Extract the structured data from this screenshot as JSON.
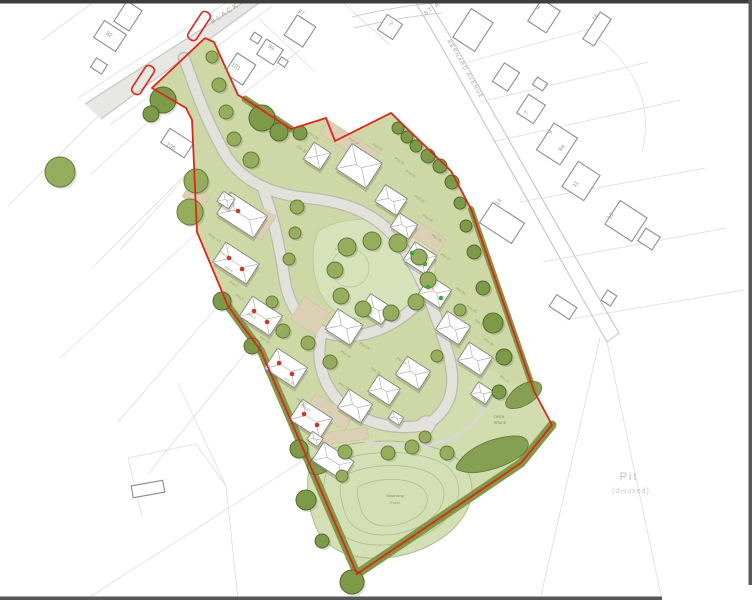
{
  "canvas": {
    "width": 752,
    "height": 600,
    "background": "#ffffff"
  },
  "colors": {
    "site_fill": "#cdd8a6",
    "open_space_fill": "#d1dcaf",
    "lap_fill": "#d8e2ba",
    "lap_stroke": "#bac697",
    "pond_fill": "#d5dfb5",
    "pond_contour": "#b0bc90",
    "road_fill": "#e2e2db",
    "road_casing": "#b9bab1",
    "existing_road_fill": "#e7e7e4",
    "existing_road_edge": "#c6c6c2",
    "footpath": "#d8d8d1",
    "tan_fill": "#dbcfb4",
    "tan_stroke": "#cabfa2",
    "parcel_line": "#dcdcd9",
    "building_stroke": "#8f8f8c",
    "house_stroke": "#85857f",
    "roof_line": "#b3b3ad",
    "tree_fill": "#95ad5d",
    "tree_stroke": "#647c35",
    "tree_dark_fill": "#7d9a48",
    "tree_dark_stroke": "#526b2b",
    "hedge": "#7e9a46",
    "boundary_red": "#e1251b",
    "marker_red": "#d93025",
    "marker_green": "#3daa35",
    "label_gray": "#9b9b98",
    "street_gray": "#a3a3a0",
    "plot_label": "#8e9c6a",
    "pit_gray": "#c2c2c0"
  },
  "viewer_edges": [
    {
      "x": 0,
      "y": 0,
      "w": 752,
      "h": 3.5,
      "c": "#3d3d3d"
    },
    {
      "x": 748.5,
      "y": 0,
      "w": 3.5,
      "h": 585,
      "c": "#5a5a5a"
    },
    {
      "x": 0,
      "y": 596.5,
      "w": 662,
      "h": 3.5,
      "c": "#575757"
    }
  ],
  "parcel_lines": [
    [
      98,
      116,
      8,
      206
    ],
    [
      190,
      170,
      92,
      268
    ],
    [
      197,
      233,
      60,
      358
    ],
    [
      222,
      301,
      118,
      422
    ],
    [
      251,
      346,
      148,
      474
    ],
    [
      178,
      383,
      226,
      486
    ],
    [
      226,
      486,
      238,
      600
    ],
    [
      88,
      598,
      310,
      456
    ],
    [
      128,
      458,
      196,
      444
    ],
    [
      196,
      444,
      226,
      486
    ],
    [
      128,
      458,
      142,
      516
    ],
    [
      468,
      62,
      608,
      24
    ],
    [
      480,
      102,
      648,
      62
    ],
    [
      492,
      142,
      680,
      100
    ],
    [
      520,
      202,
      706,
      168
    ],
    [
      543,
      262,
      726,
      228
    ],
    [
      566,
      320,
      744,
      290
    ],
    [
      607,
      342,
      662,
      600
    ],
    [
      600,
      338,
      540,
      600
    ],
    [
      258,
      18,
      315,
      72
    ],
    [
      300,
      50,
      240,
      96
    ],
    [
      340,
      0,
      390,
      45
    ],
    [
      150,
      120,
      90,
      175
    ],
    [
      200,
      160,
      120,
      250
    ],
    [
      96,
      0,
      42,
      40
    ]
  ],
  "existing_roads": [
    {
      "d": "M247,0 L263,0 L101,119 L85,104 Z",
      "fill": "#e7e7e4"
    },
    {
      "d": "M247,0 L85,104",
      "stroke": "#c6c6c2",
      "w": 1.2
    },
    {
      "d": "M263,0 L101,119",
      "stroke": "#c6c6c2",
      "w": 1.2
    },
    {
      "d": "M272,6 L110,125",
      "stroke": "#dddddb",
      "w": 0.8
    },
    {
      "d": "M78,98 L240,-6",
      "stroke": "#dddddb",
      "w": 0.8
    },
    {
      "d": "M414,0 C446,52 510,170 607,342",
      "stroke": "#c6c6c2",
      "w": 1.1
    },
    {
      "d": "M428,0 C460,50 522,166 619,333",
      "stroke": "#c6c6c2",
      "w": 1.1
    },
    {
      "d": "M607,342 L619,333",
      "stroke": "#c6c6c2",
      "w": 1
    },
    {
      "d": "M352,17 Q392,7 434,3",
      "stroke": "#cfcfcb",
      "w": 1
    },
    {
      "d": "M354,28 Q396,18 441,13",
      "stroke": "#cfcfcb",
      "w": 1
    },
    {
      "d": "M600,40 Q658,86 642,152",
      "stroke": "#e0e0dd",
      "w": 0.8
    }
  ],
  "existing_buildings": [
    [
      110,
      36,
      26,
      20,
      33
    ],
    [
      128,
      16,
      18,
      24,
      33
    ],
    [
      99,
      66,
      13,
      11,
      33
    ],
    [
      177,
      143,
      28,
      17,
      33
    ],
    [
      240,
      69,
      22,
      24,
      33
    ],
    [
      270,
      52,
      20,
      18,
      33
    ],
    [
      300,
      31,
      22,
      24,
      33
    ],
    [
      390,
      27,
      18,
      18,
      33
    ],
    [
      473,
      30,
      26,
      34,
      33
    ],
    [
      506,
      77,
      18,
      22,
      33
    ],
    [
      531,
      109,
      20,
      22,
      33
    ],
    [
      557,
      144,
      28,
      32,
      33
    ],
    [
      581,
      181,
      26,
      30,
      33
    ],
    [
      626,
      221,
      32,
      28,
      33
    ],
    [
      502,
      223,
      38,
      24,
      33
    ],
    [
      544,
      16,
      22,
      26,
      33
    ],
    [
      597,
      29,
      13,
      32,
      33
    ],
    [
      563,
      307,
      24,
      14,
      33
    ],
    [
      609,
      298,
      11,
      12,
      33
    ],
    [
      649,
      239,
      17,
      15,
      33
    ],
    [
      148,
      489,
      32,
      12,
      -10
    ],
    [
      256,
      38,
      9,
      8,
      33
    ],
    [
      283,
      62,
      8,
      7,
      33
    ],
    [
      540,
      84,
      12,
      9,
      33
    ]
  ],
  "site": {
    "fill_d": "M205,38 L214,42 L238,95 L245,99 L291,129 L326,118 L335,141 L391,113 L451,171 L471,209 L534,391 L552,425 L521,463 L357,574 L304,451 L261,351 L228,306 L197,232 L192,120 L186,108 L152,88 Z",
    "boundary_d": "M205,38 L214,42 L238,95 L245,99 L291,129 L326,118 L335,141 L391,113 L451,171 L471,209 L534,391 L552,425 L521,463 L357,574 L304,451 L261,351 L228,306 L197,232 L192,120 L186,108 L152,88 L205,38",
    "open_space_d": "M447,350 L534,391 L552,425 L521,463 L357,574 L304,451 L340,402 C362,424 398,432 428,424 C446,414 452,384 447,350 Z",
    "splays": [
      {
        "x": 199,
        "y": 26,
        "w": 10,
        "h": 32,
        "r": 33
      },
      {
        "x": 143,
        "y": 80,
        "w": 10,
        "h": 32,
        "r": 33
      }
    ]
  },
  "lap": {
    "blob_d": "M318,232 C330,222 352,218 375,220 C400,222 420,228 430,244 C438,258 436,278 428,294 C418,312 398,320 374,320 C348,320 330,312 322,296 C312,278 310,248 318,232 Z",
    "play_circle": {
      "cx": 350,
      "cy": 268,
      "r": 19
    }
  },
  "pond": {
    "basin_d": "M316,455 C350,438 410,436 446,452 C472,464 478,490 466,512 C452,538 418,556 382,558 C348,560 322,548 314,522 C306,500 304,470 316,455 Z",
    "contours": [
      "M330,465 C358,450 408,448 438,461 C458,470 464,490 454,508 C442,530 414,544 384,545 C356,546 334,536 328,515 C322,498 322,477 330,465 Z",
      "M344,476 C366,464 404,462 428,472 C444,480 448,494 440,508 C430,524 408,534 386,535 C364,536 348,527 344,510 C340,496 338,486 344,476 Z",
      "M358,487 C374,478 400,477 416,484 C428,490 430,500 424,510 C416,520 400,526 386,526 C372,526 362,518 360,506 C358,498 356,493 358,487 Z"
    ]
  },
  "internal_roads": [
    "M184,58 C196,90 204,116 224,152 C240,180 268,194 308,198 C346,202 372,212 394,236 C418,264 434,308 447,350 C458,384 452,408 428,424",
    "M262,186 C274,218 280,248 284,276 C288,304 299,321 322,331 C352,344 396,332 428,292",
    "M322,331 C316,356 320,382 340,402 C362,424 398,432 428,424"
  ],
  "turning_head": {
    "cx": 426,
    "cy": 425,
    "r": 8.5
  },
  "footpath_d": "M366,441 C396,450 428,448 452,438 C468,430 478,420 486,406",
  "tan_areas": [
    [
      349,
      143,
      60,
      16,
      33
    ],
    [
      310,
      316,
      30,
      26,
      33
    ],
    [
      330,
      412,
      44,
      18,
      30
    ],
    [
      428,
      237,
      34,
      16,
      33
    ],
    [
      196,
      197,
      24,
      14,
      33
    ],
    [
      345,
      436,
      46,
      12,
      -8
    ],
    [
      262,
      224,
      16,
      28,
      33
    ]
  ],
  "hedges": [
    {
      "d": "M228,306 L261,351 L304,451 L357,574",
      "w": 8
    },
    {
      "d": "M552,425 L521,463 L357,574",
      "w": 9
    },
    {
      "d": "M471,209 L534,391",
      "w": 6
    },
    {
      "d": "M245,99 L291,129",
      "w": 7
    }
  ],
  "mounds": [
    "M458,463 C468,448 490,438 512,436 C527,435 533,443 524,453 C509,467 478,475 465,472 C456,470 454,469 458,463 Z",
    "M509,396 C515,386 528,380 537,382 C544,384 543,392 535,399 C526,407 515,410 509,408 C504,406 505,401 509,396 Z",
    "M310,462 C316,452 328,448 334,452 C339,456 336,464 328,470 C320,476 310,476 308,470 C307,467 307,465 310,462 Z"
  ],
  "houses": [
    {
      "x": 242,
      "y": 215,
      "w": 44,
      "h": 26,
      "r": 33
    },
    {
      "x": 226,
      "y": 200,
      "w": 14,
      "h": 12,
      "r": 33
    },
    {
      "x": 236,
      "y": 263,
      "w": 40,
      "h": 24,
      "r": 33
    },
    {
      "x": 261,
      "y": 316,
      "w": 36,
      "h": 24,
      "r": 33
    },
    {
      "x": 286,
      "y": 368,
      "w": 36,
      "h": 24,
      "r": 33
    },
    {
      "x": 311,
      "y": 419,
      "w": 36,
      "h": 24,
      "r": 33
    },
    {
      "x": 333,
      "y": 461,
      "w": 36,
      "h": 22,
      "r": 33
    },
    {
      "x": 315,
      "y": 439,
      "w": 13,
      "h": 10,
      "r": 33
    },
    {
      "x": 355,
      "y": 406,
      "w": 28,
      "h": 22,
      "r": 33
    },
    {
      "x": 384,
      "y": 390,
      "w": 26,
      "h": 20,
      "r": 33
    },
    {
      "x": 413,
      "y": 373,
      "w": 28,
      "h": 22,
      "r": 33
    },
    {
      "x": 396,
      "y": 418,
      "w": 13,
      "h": 9,
      "r": 33
    },
    {
      "x": 344,
      "y": 327,
      "w": 30,
      "h": 24,
      "r": 33
    },
    {
      "x": 376,
      "y": 309,
      "w": 26,
      "h": 20,
      "r": 33
    },
    {
      "x": 317,
      "y": 156,
      "w": 20,
      "h": 20,
      "r": 33
    },
    {
      "x": 359,
      "y": 166,
      "w": 36,
      "h": 30,
      "r": 33
    },
    {
      "x": 391,
      "y": 200,
      "w": 26,
      "h": 20,
      "r": 33
    },
    {
      "x": 404,
      "y": 226,
      "w": 22,
      "h": 17,
      "r": 33
    },
    {
      "x": 420,
      "y": 258,
      "w": 26,
      "h": 22,
      "r": 33
    },
    {
      "x": 435,
      "y": 292,
      "w": 26,
      "h": 22,
      "r": 33
    },
    {
      "x": 453,
      "y": 328,
      "w": 28,
      "h": 22,
      "r": 33
    },
    {
      "x": 475,
      "y": 359,
      "w": 28,
      "h": 22,
      "r": 33
    },
    {
      "x": 482,
      "y": 393,
      "w": 18,
      "h": 15,
      "r": 33
    }
  ],
  "unit_markers": {
    "red": [
      [
        238,
        211
      ],
      [
        229,
        258
      ],
      [
        242,
        269
      ],
      [
        254,
        311
      ],
      [
        267,
        322
      ],
      [
        279,
        363
      ],
      [
        292,
        374
      ],
      [
        304,
        414
      ],
      [
        317,
        425
      ]
    ],
    "green": [
      [
        412,
        253
      ],
      [
        425,
        264
      ],
      [
        428,
        287
      ],
      [
        441,
        298
      ]
    ]
  },
  "trees": [
    [
      163,
      100,
      13,
      "d"
    ],
    [
      151,
      114,
      8,
      "d"
    ],
    [
      60,
      172,
      15,
      "n"
    ],
    [
      196,
      181,
      12,
      "n"
    ],
    [
      190,
      212,
      13,
      "n"
    ],
    [
      212,
      57,
      6,
      "n"
    ],
    [
      219,
      85,
      7,
      "n"
    ],
    [
      226,
      112,
      7,
      "n"
    ],
    [
      234,
      139,
      7,
      "n"
    ],
    [
      251,
      160,
      8,
      "n"
    ],
    [
      262,
      118,
      13,
      "d"
    ],
    [
      279,
      132,
      9,
      "d"
    ],
    [
      300,
      133,
      7,
      "d"
    ],
    [
      398,
      128,
      6,
      "d"
    ],
    [
      407,
      137,
      6,
      "d"
    ],
    [
      416,
      146,
      6,
      "d"
    ],
    [
      428,
      156,
      7,
      "d"
    ],
    [
      440,
      166,
      7,
      "d"
    ],
    [
      452,
      182,
      7,
      "d"
    ],
    [
      460,
      203,
      6,
      "d"
    ],
    [
      466,
      226,
      6,
      "d"
    ],
    [
      474,
      252,
      7,
      "d"
    ],
    [
      483,
      288,
      7,
      "d"
    ],
    [
      493,
      323,
      10,
      "d"
    ],
    [
      504,
      357,
      8,
      "d"
    ],
    [
      499,
      392,
      7,
      "d"
    ],
    [
      347,
      247,
      9,
      "n"
    ],
    [
      372,
      241,
      9,
      "n"
    ],
    [
      398,
      243,
      9,
      "n"
    ],
    [
      419,
      257,
      8,
      "n"
    ],
    [
      428,
      280,
      8,
      "n"
    ],
    [
      416,
      302,
      8,
      "n"
    ],
    [
      391,
      313,
      8,
      "n"
    ],
    [
      363,
      309,
      8,
      "n"
    ],
    [
      341,
      296,
      8,
      "n"
    ],
    [
      335,
      270,
      8,
      "n"
    ],
    [
      297,
      207,
      7,
      "n"
    ],
    [
      295,
      233,
      6,
      "n"
    ],
    [
      289,
      259,
      6,
      "n"
    ],
    [
      272,
      302,
      6,
      "n"
    ],
    [
      283,
      331,
      7,
      "n"
    ],
    [
      308,
      343,
      7,
      "n"
    ],
    [
      330,
      362,
      7,
      "n"
    ],
    [
      222,
      301,
      9,
      "d"
    ],
    [
      252,
      346,
      8,
      "d"
    ],
    [
      299,
      449,
      9,
      "d"
    ],
    [
      306,
      500,
      10,
      "d"
    ],
    [
      352,
      582,
      12,
      "d"
    ],
    [
      322,
      541,
      7,
      "d"
    ],
    [
      345,
      452,
      7,
      "n"
    ],
    [
      388,
      453,
      7,
      "n"
    ],
    [
      412,
      447,
      7,
      "n"
    ],
    [
      425,
      437,
      6,
      "n"
    ],
    [
      447,
      453,
      7,
      "n"
    ],
    [
      342,
      476,
      6,
      "n"
    ],
    [
      460,
      310,
      6,
      "n"
    ],
    [
      437,
      356,
      6,
      "n"
    ]
  ],
  "street_labels": [
    {
      "t": "BLACK",
      "x": 226,
      "y": 15,
      "rot": -33,
      "s": 7,
      "ls": 2
    },
    {
      "t": "ST A",
      "x": 433,
      "y": 10,
      "rot": -36,
      "s": 6,
      "ls": 1.5
    },
    {
      "t": "BERNARD AVENUE",
      "x": 464,
      "y": 70,
      "rot": 60,
      "s": 5.5,
      "ls": 1.2
    }
  ],
  "house_numbers": [
    {
      "t": "92",
      "x": 108,
      "y": 36,
      "rot": 33
    },
    {
      "t": "97",
      "x": 300,
      "y": 14,
      "rot": 33
    },
    {
      "t": "99",
      "x": 270,
      "y": 49,
      "rot": 33
    },
    {
      "t": "101",
      "x": 235,
      "y": 68,
      "rot": 33
    },
    {
      "t": "105",
      "x": 170,
      "y": 148,
      "rot": 33
    },
    {
      "t": "2",
      "x": 390,
      "y": 25,
      "rot": 33
    },
    {
      "t": "3",
      "x": 537,
      "y": 9,
      "rot": 33
    },
    {
      "t": "16",
      "x": 597,
      "y": 18,
      "rot": -57
    },
    {
      "t": "7",
      "x": 528,
      "y": 114,
      "rot": -57
    },
    {
      "t": "9",
      "x": 552,
      "y": 133,
      "rot": -57
    },
    {
      "t": "9a",
      "x": 563,
      "y": 149,
      "rot": -57
    },
    {
      "t": "11",
      "x": 577,
      "y": 185,
      "rot": -57
    },
    {
      "t": "13",
      "x": 612,
      "y": 217,
      "rot": -57
    },
    {
      "t": "14",
      "x": 500,
      "y": 203,
      "rot": -57
    }
  ],
  "plot_labels": [
    {
      "t": "Plots 1-4",
      "x": 214,
      "y": 239
    },
    {
      "t": "Plot 5",
      "x": 223,
      "y": 255
    },
    {
      "t": "Plot 6",
      "x": 228,
      "y": 270
    },
    {
      "t": "Plot 7",
      "x": 233,
      "y": 285
    },
    {
      "t": "Plot 8",
      "x": 239,
      "y": 298
    },
    {
      "t": "Plot 9",
      "x": 251,
      "y": 317
    },
    {
      "t": "Plot 10",
      "x": 264,
      "y": 341
    },
    {
      "t": "Plot 11",
      "x": 288,
      "y": 382
    },
    {
      "t": "Plot 12",
      "x": 301,
      "y": 403
    },
    {
      "t": "Plot 13",
      "x": 326,
      "y": 367
    },
    {
      "t": "Plot 14",
      "x": 345,
      "y": 355
    },
    {
      "t": "Plot 15",
      "x": 364,
      "y": 347
    },
    {
      "t": "Plot 16",
      "x": 343,
      "y": 387
    },
    {
      "t": "Plot 17",
      "x": 305,
      "y": 409
    },
    {
      "t": "Plot 18",
      "x": 375,
      "y": 372
    },
    {
      "t": "Plot 19",
      "x": 401,
      "y": 362
    },
    {
      "t": "Plot 20",
      "x": 499,
      "y": 397
    },
    {
      "t": "Plot 21",
      "x": 504,
      "y": 380
    },
    {
      "t": "Plot 22",
      "x": 496,
      "y": 362
    },
    {
      "t": "Plot 23",
      "x": 488,
      "y": 343
    },
    {
      "t": "Plot 24",
      "x": 479,
      "y": 324
    },
    {
      "t": "Plot 25",
      "x": 471,
      "y": 310
    },
    {
      "t": "Plot 26",
      "x": 460,
      "y": 292
    },
    {
      "t": "Plot 27",
      "x": 445,
      "y": 258
    },
    {
      "t": "Plot 28",
      "x": 436,
      "y": 239
    },
    {
      "t": "Plot 29",
      "x": 427,
      "y": 219
    },
    {
      "t": "Plot 30",
      "x": 419,
      "y": 200
    },
    {
      "t": "Plot 31",
      "x": 410,
      "y": 175
    },
    {
      "t": "Plot 32",
      "x": 399,
      "y": 162
    },
    {
      "t": "Plot 33",
      "x": 377,
      "y": 148
    },
    {
      "t": "Plot 34",
      "x": 353,
      "y": 142
    },
    {
      "t": "Plot 35",
      "x": 313,
      "y": 137
    },
    {
      "t": "Plot 36",
      "x": 301,
      "y": 150
    }
  ],
  "annotations": [
    {
      "t": "LAP",
      "x": 339,
      "y": 250,
      "s": 4,
      "c": "#93a073"
    },
    {
      "t": "OPEN",
      "x": 499,
      "y": 418,
      "s": 3.8,
      "c": "#7e8f5a"
    },
    {
      "t": "SPACE",
      "x": 500,
      "y": 424,
      "s": 3.8,
      "c": "#7e8f5a"
    },
    {
      "t": "Balancing",
      "x": 395,
      "y": 497,
      "s": 4,
      "c": "#8a9175"
    },
    {
      "t": "Pond",
      "x": 395,
      "y": 504,
      "s": 4,
      "c": "#8a9175"
    },
    {
      "t": "Pit",
      "x": 629,
      "y": 480,
      "s": 11,
      "c": "#c2c2c0",
      "ls": 2
    },
    {
      "t": "(disused)",
      "x": 631,
      "y": 493,
      "s": 7,
      "c": "#c6c6c4",
      "ls": 1
    }
  ]
}
